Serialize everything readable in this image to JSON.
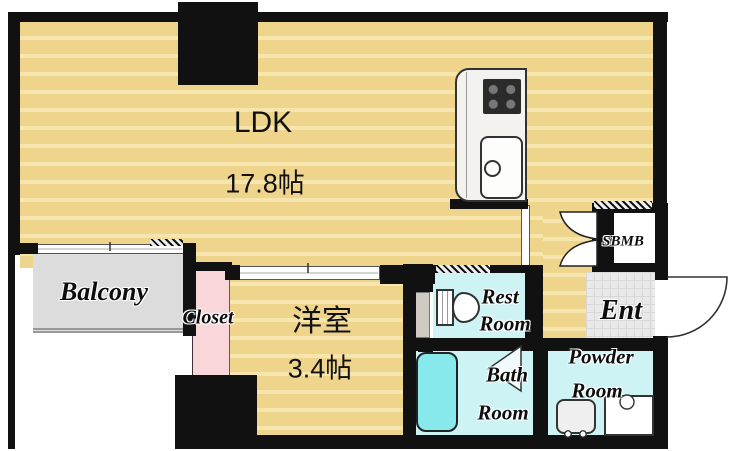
{
  "plan": {
    "type": "apartment-floorplan",
    "rooms": {
      "ldk": {
        "label": "LDK",
        "area": "17.8帖"
      },
      "western_room": {
        "label": "洋室",
        "area": "3.4帖"
      },
      "balcony": {
        "label": "Balcony"
      },
      "closet": {
        "label": "Closet"
      },
      "rest_room": {
        "label_line1": "Rest",
        "label_line2": "Room"
      },
      "bath_room": {
        "label_line1": "Bath",
        "label_line2": "Room"
      },
      "powder_room": {
        "label_line1": "Powder",
        "label_line2": "Room"
      },
      "entrance": {
        "label": "Ent"
      },
      "shoe_box": {
        "label": "SBMB"
      }
    },
    "fixtures": [
      "kitchen-stove",
      "kitchen-sink",
      "toilet",
      "bathtub",
      "washbasin",
      "washing-machine-pan"
    ],
    "colors": {
      "wall": "#111111",
      "wood_floor": "#efd48c",
      "wood_floor_stripe": "#f7e5ae",
      "wet_floor": "#cdf3f4",
      "bathtub": "#87e9ec",
      "closet": "#f8d6da",
      "balcony": "#dcdcdc",
      "entrance_floor": "#e9e9e9"
    }
  }
}
